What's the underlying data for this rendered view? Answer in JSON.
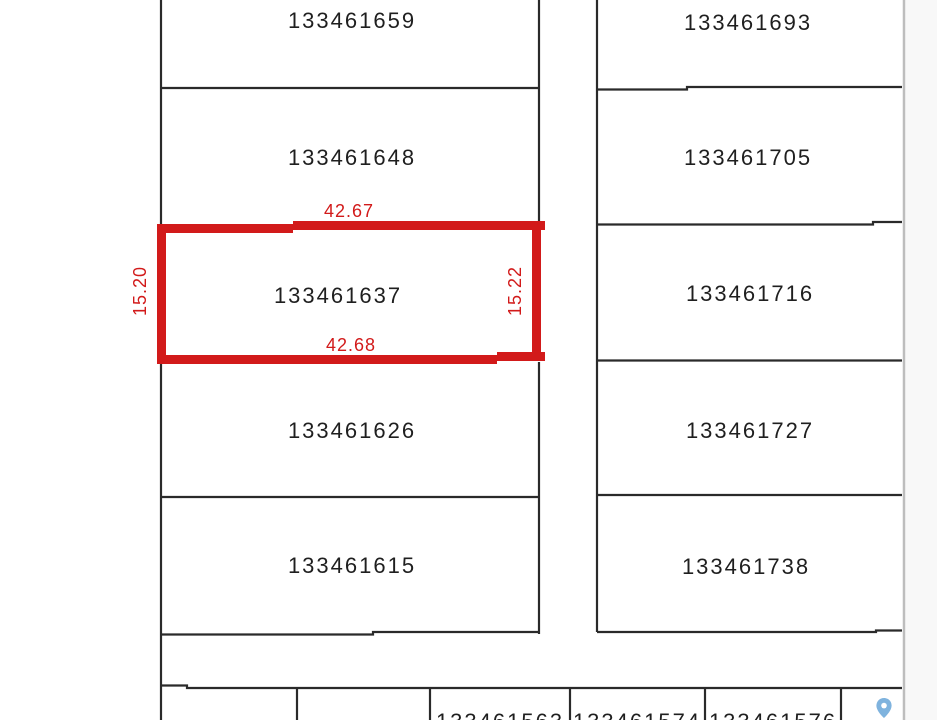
{
  "map_view": {
    "selected_parcel": {
      "id": "133461637",
      "dimensions": {
        "top": "42.67",
        "bottom": "42.68",
        "left": "15.20",
        "right": "15.22"
      }
    },
    "parcels": {
      "left_column": [
        "133461659",
        "133461648",
        "133461637",
        "133461626",
        "133461615"
      ],
      "right_column": [
        "133461693",
        "133461705",
        "133461716",
        "133461727",
        "133461738"
      ],
      "bottom_row": [
        "133461563",
        "133461574",
        "133461576"
      ]
    },
    "colors": {
      "highlight": "#d21a1a",
      "parcel_line": "#2a2a2a",
      "label_text": "#1f1f1f",
      "viewport_edge": "#bdbdbd",
      "pin_fill": "#7fb3de"
    },
    "icons": {
      "pin": "map-pin"
    }
  }
}
